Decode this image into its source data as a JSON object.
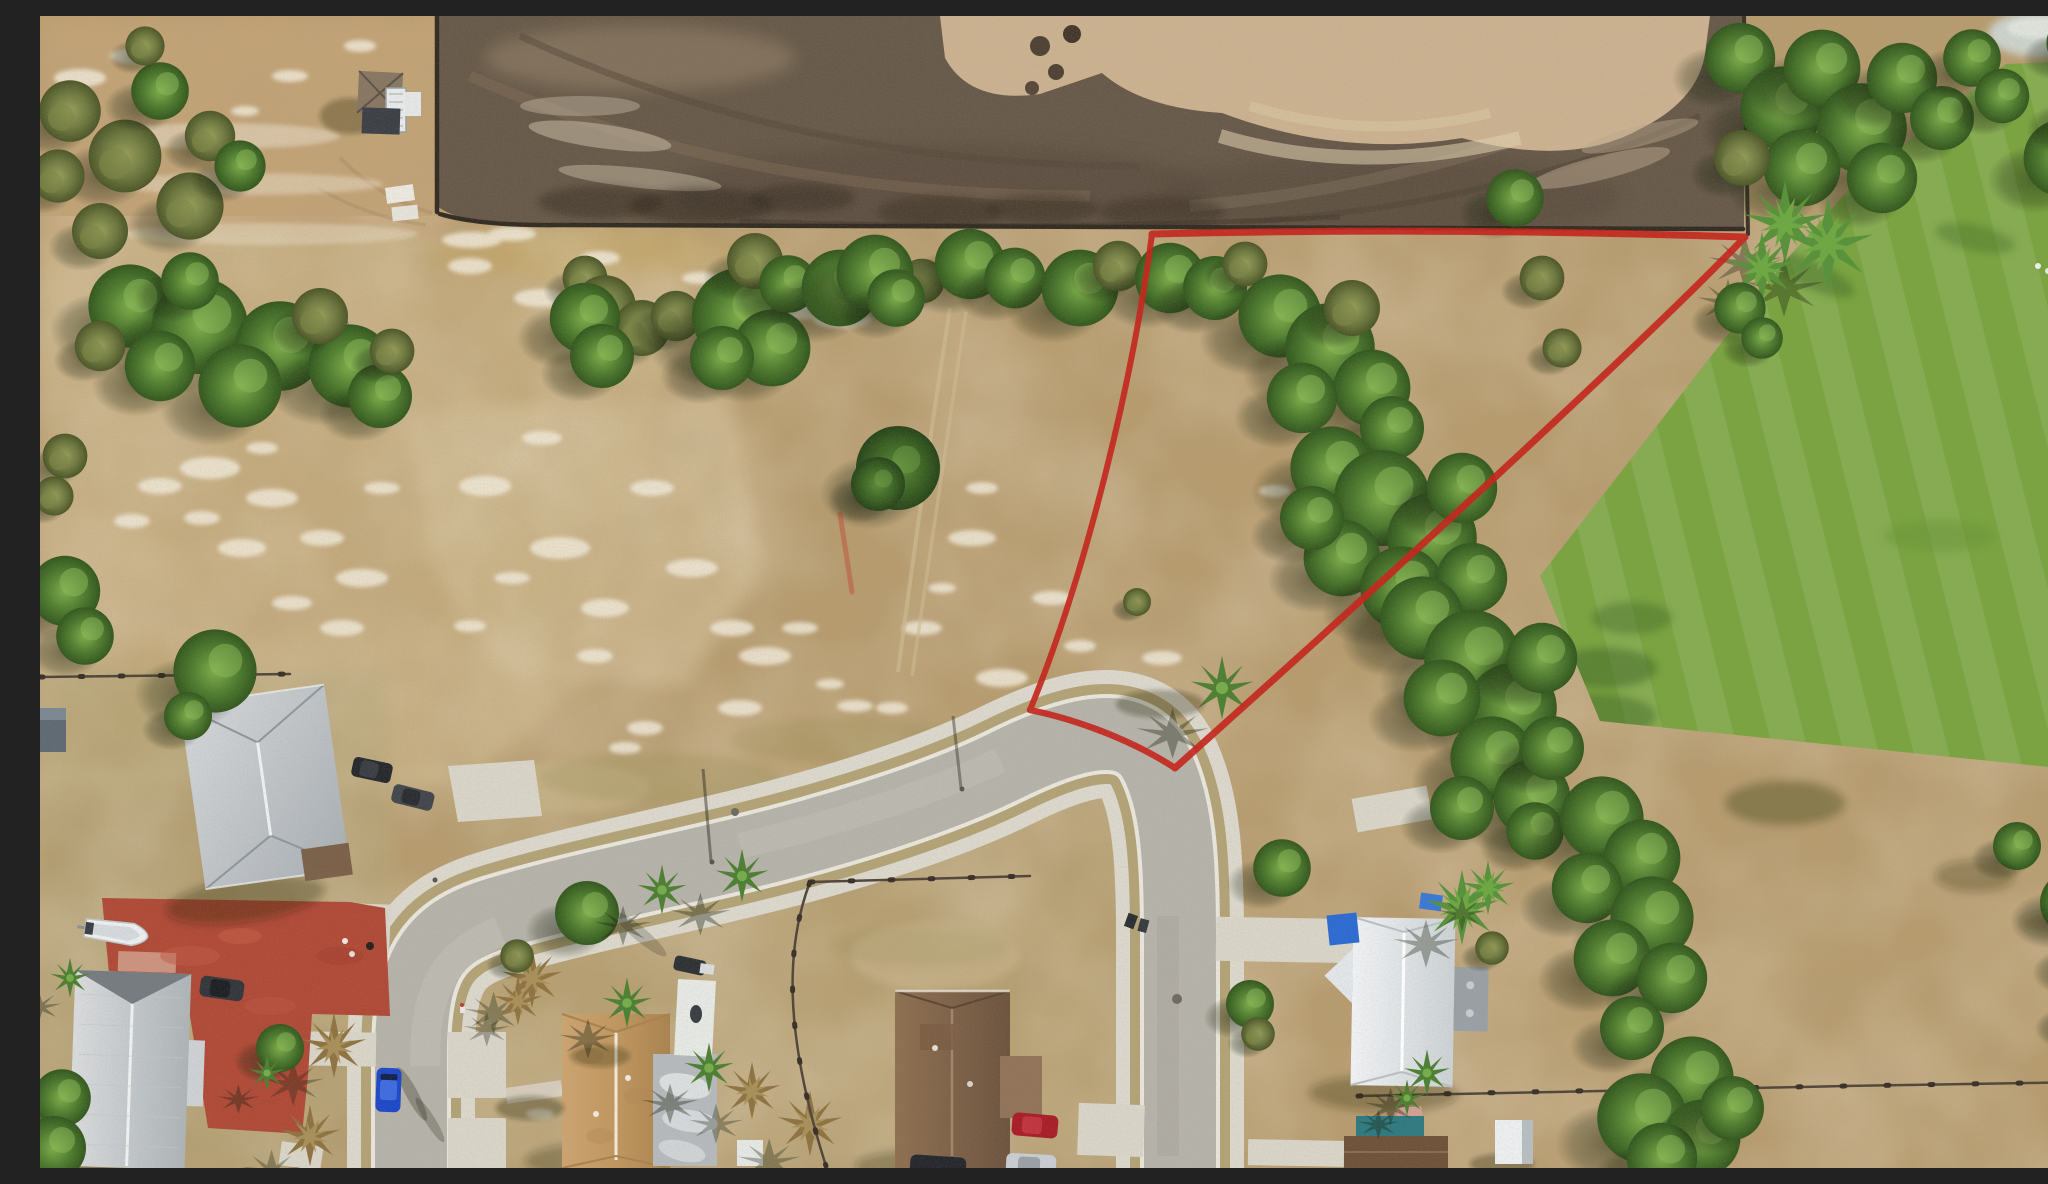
{
  "scene": {
    "type": "aerial-drone-photograph",
    "description": "Aerial drone photo of a vacant residential corner lot outlined in red survey paint, bordered by a dark graded construction site to the north, a curving suburban street with white sidewalks wrapping the lot to the south and west, single-family homes with metal and shingle roofs, palm trees, dry sandy grass, and a bright mowed green field to the east.",
    "no_visible_text": true
  },
  "boundary": {
    "color": "#c6261d",
    "style": "hand-painted red survey line",
    "vertices_px": [
      [
        1112,
        218
      ],
      [
        1705,
        221
      ],
      [
        1135,
        752
      ],
      [
        990,
        694
      ]
    ],
    "follows_road_curb_between": [
      [
        990,
        694
      ],
      [
        1135,
        752
      ]
    ]
  },
  "colors": {
    "dry_field": "#b79c6f",
    "pale_scrub": "#c3aa7d",
    "topleft_dirt": "#c2a377",
    "churned_soil": "#685a4a",
    "sand": "#cbb291",
    "lawn": "#7aa440",
    "pavement": "#b6b3aa",
    "sidewalk": "#dcd8cd",
    "curb": "#e9e6dd",
    "patio_red": "#b04a38",
    "tree_green": "#4f7d30",
    "blue_car": "#1d49c8",
    "red_car": "#a81e28",
    "silver_car": "#c9ced4",
    "boat_white": "#edeff1",
    "tarp_blue": "#2d6bd3",
    "pool_teal": "#2f7a80"
  },
  "objects": {
    "construction_site": {
      "label": "graded dirt site with tire tracks, sand excavation bowl and silt fence",
      "area": "top of frame"
    },
    "vacant_lot": {
      "label": "red-outlined vacant parcel with scattered trees and white sand patches",
      "area": "center"
    },
    "street": {
      "label": "horseshoe-curved residential street with sidewalks and driveway aprons",
      "shape": "U-bend opening to bottom edge"
    },
    "lawn": {
      "label": "mowed bright green field with mower stripes",
      "area": "right"
    },
    "houses": [
      {
        "label": "gray metal hip-roof house",
        "area": "left"
      },
      {
        "label": "large white metal gable-roof house",
        "area": "bottom-left"
      },
      {
        "label": "tan shingle hip-roof house with gray garage and white shed",
        "area": "bottom-center-left"
      },
      {
        "label": "brown shingle hip-roof house",
        "area": "bottom-center"
      },
      {
        "label": "white metal roof house with blue tarps and flat garage",
        "area": "bottom-right of street"
      },
      {
        "label": "brown roof house with teal pool enclosure and pink shed",
        "area": "bottom edge right"
      },
      {
        "label": "small hip-roof shed with utility trailer",
        "area": "top-left"
      },
      {
        "label": "white cube shed",
        "area": "bottom-right"
      }
    ],
    "vehicles": [
      {
        "label": "dark pickup truck",
        "area": "upper-left field"
      },
      {
        "label": "two dark cars parked at road bend",
        "area": "left of street bend"
      },
      {
        "label": "blue car parked on west leg of street"
      },
      {
        "label": "dark car on red patio"
      },
      {
        "label": "red car and silver car in driveway",
        "area": "east of brown house"
      },
      {
        "label": "white boat on trailer",
        "area": "red patio"
      }
    ],
    "red_patio": {
      "label": "red-painted concrete patio and drive",
      "area": "bottom-left between houses"
    },
    "fences": [
      {
        "label": "silt fence along construction edge"
      },
      {
        "label": "wire fence west yard"
      },
      {
        "label": "backyard fence of island lots"
      },
      {
        "label": "wooden fence across bottom-right field"
      }
    ],
    "vegetation": {
      "label": "oaks, pines, sabal palms with starburst shadows, olive scrub rows, dead brown palms"
    }
  }
}
